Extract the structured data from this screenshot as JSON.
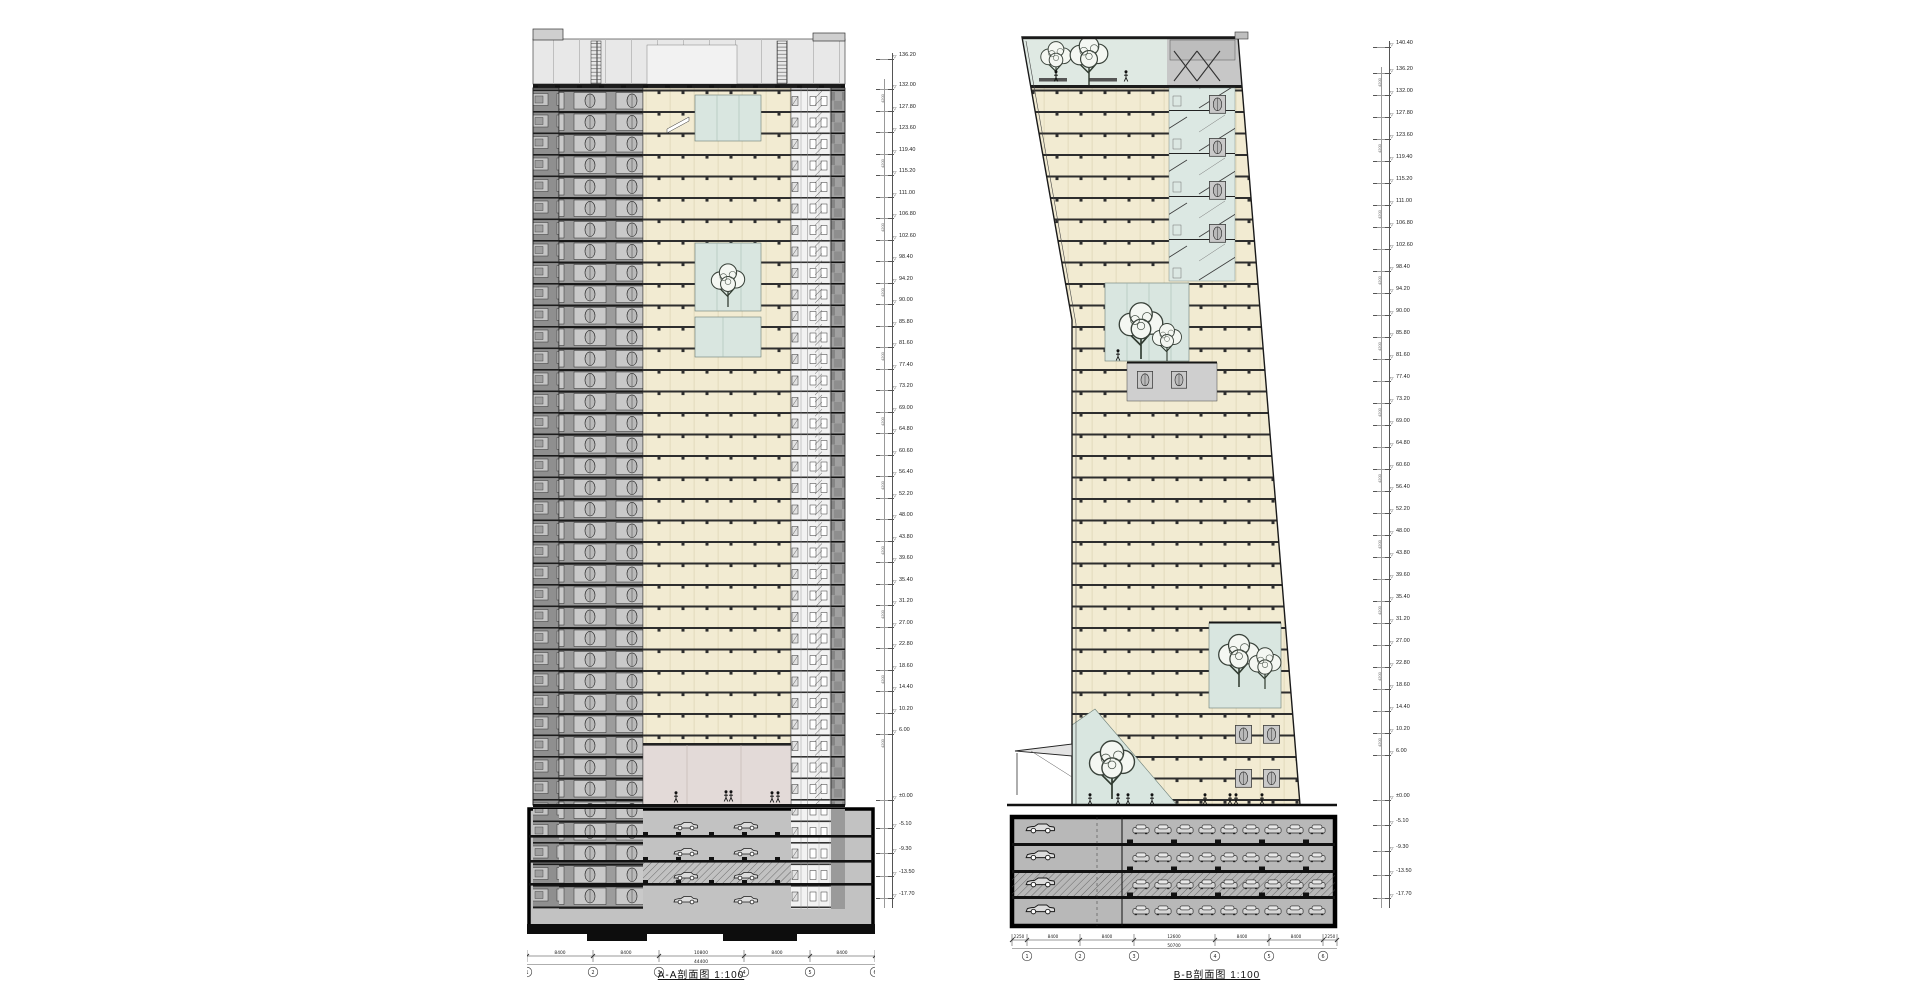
{
  "drawings": {
    "left": {
      "caption": "A-A剖面图  1:100",
      "dim_segments": [
        "8400",
        "8400",
        "10800",
        "8400",
        "8400"
      ],
      "dim_total": "44400",
      "grid_bubbles": [
        "1",
        "2",
        "3",
        "4",
        "5",
        "6"
      ]
    },
    "right": {
      "caption": "B-B剖面图  1:100",
      "dim_segments": [
        "2250",
        "8400",
        "8400",
        "12600",
        "8400",
        "8400",
        "2250"
      ],
      "dim_total": "50700",
      "grid_bubbles": [
        "1",
        "2",
        "3",
        "4",
        "5",
        "6"
      ]
    }
  },
  "scales": {
    "floor_height_label": "4200",
    "left": {
      "levels": [
        "136.20",
        "132.00",
        "127.80",
        "123.60",
        "119.40",
        "115.20",
        "111.00",
        "106.80",
        "102.60",
        "98.40",
        "94.20",
        "90.00",
        "85.80",
        "81.60",
        "77.40",
        "73.20",
        "69.00",
        "64.80",
        "60.60",
        "56.40",
        "52.20",
        "48.00",
        "43.80",
        "39.60",
        "35.40",
        "31.20",
        "27.00",
        "22.80",
        "18.60",
        "14.40",
        "10.20",
        "6.00",
        "±0.00",
        "-5.10",
        "-9.30",
        "-13.50",
        "-17.70"
      ]
    },
    "right": {
      "levels": [
        "140.40",
        "136.20",
        "132.00",
        "127.80",
        "123.60",
        "119.40",
        "115.20",
        "111.00",
        "106.80",
        "102.60",
        "98.40",
        "94.20",
        "90.00",
        "85.80",
        "81.60",
        "77.40",
        "73.20",
        "69.00",
        "64.80",
        "60.60",
        "56.40",
        "52.20",
        "48.00",
        "43.80",
        "39.60",
        "35.40",
        "31.20",
        "27.00",
        "22.80",
        "18.60",
        "14.40",
        "10.20",
        "6.00",
        "±0.00",
        "-5.10",
        "-9.30",
        "-13.50",
        "-17.70"
      ]
    }
  },
  "colors": {
    "floor_cream": "#f2ebd2",
    "core_gray": "#9c9c9c",
    "atrium_green": "#d9e6e0",
    "lobby_pink": "#e3dad8",
    "basement_gray": "#c2c2c2",
    "crown_gray": "#e8e8e8",
    "line_dark": "#1c1c1c"
  }
}
